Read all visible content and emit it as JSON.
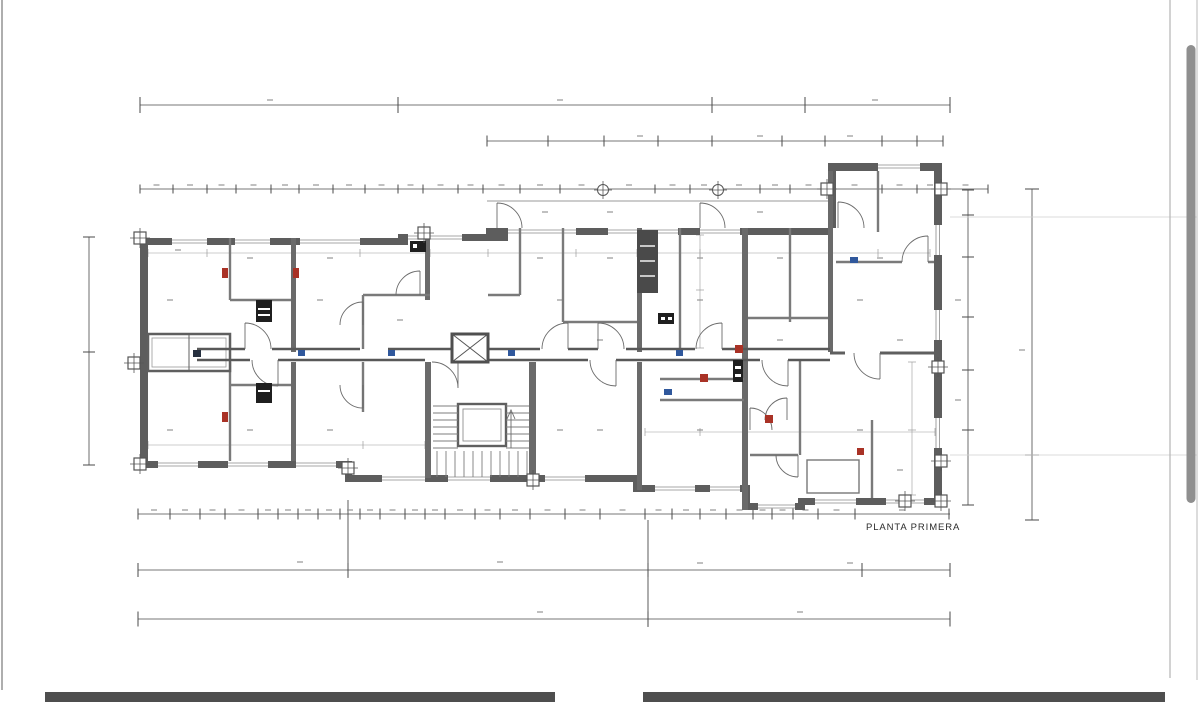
{
  "document": {
    "kind": "architectural-floor-plan",
    "plan_label": "PLANTA PRIMERA"
  },
  "colors": {
    "wall": "#5d5d5d",
    "thin_line": "#454545",
    "dimension_line": "#4a4a4a",
    "marker_red": "#a93226",
    "marker_blue": "#30589c",
    "marker_black": "#1f1f1f",
    "scrollbar_thumb": "#8f8f8f",
    "next_page_bar": "#4e4e4e",
    "paper": "#ffffff"
  },
  "ui": {
    "scrollbar_present": true,
    "next_page_fragments": 2
  }
}
